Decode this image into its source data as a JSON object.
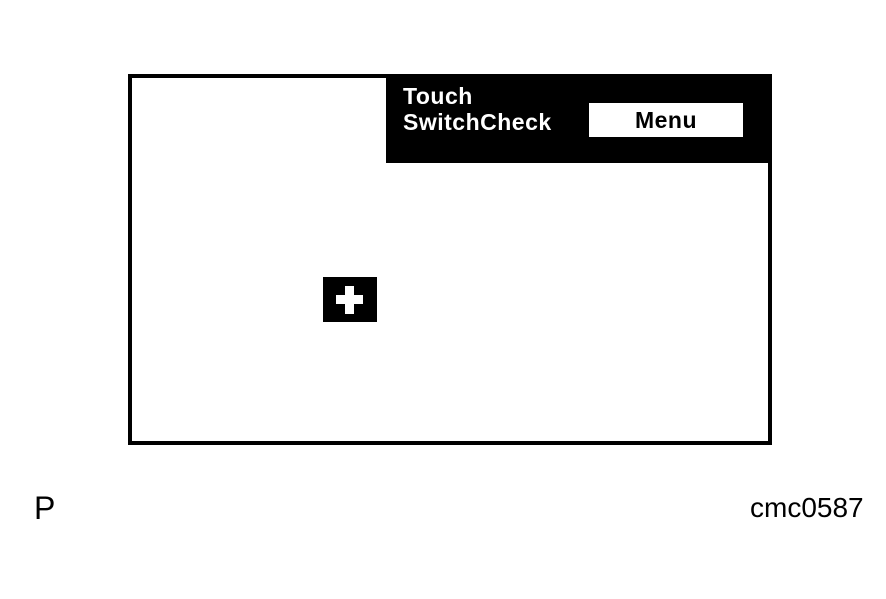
{
  "device_screen": {
    "header": {
      "title_line1": "Touch",
      "title_line2": "SwitchCheck",
      "menu_button_label": "Menu"
    },
    "touch_target": {
      "icon": "plus-crosshair-icon"
    }
  },
  "annotations": {
    "page_marker": "P",
    "figure_code": "cmc0587"
  },
  "colors": {
    "background": "#ffffff",
    "screen_border": "#000000",
    "header_bg": "#000000",
    "header_text": "#ffffff",
    "menu_button_bg": "#ffffff",
    "menu_button_text": "#000000",
    "target_bg": "#000000",
    "target_cross": "#ffffff"
  }
}
